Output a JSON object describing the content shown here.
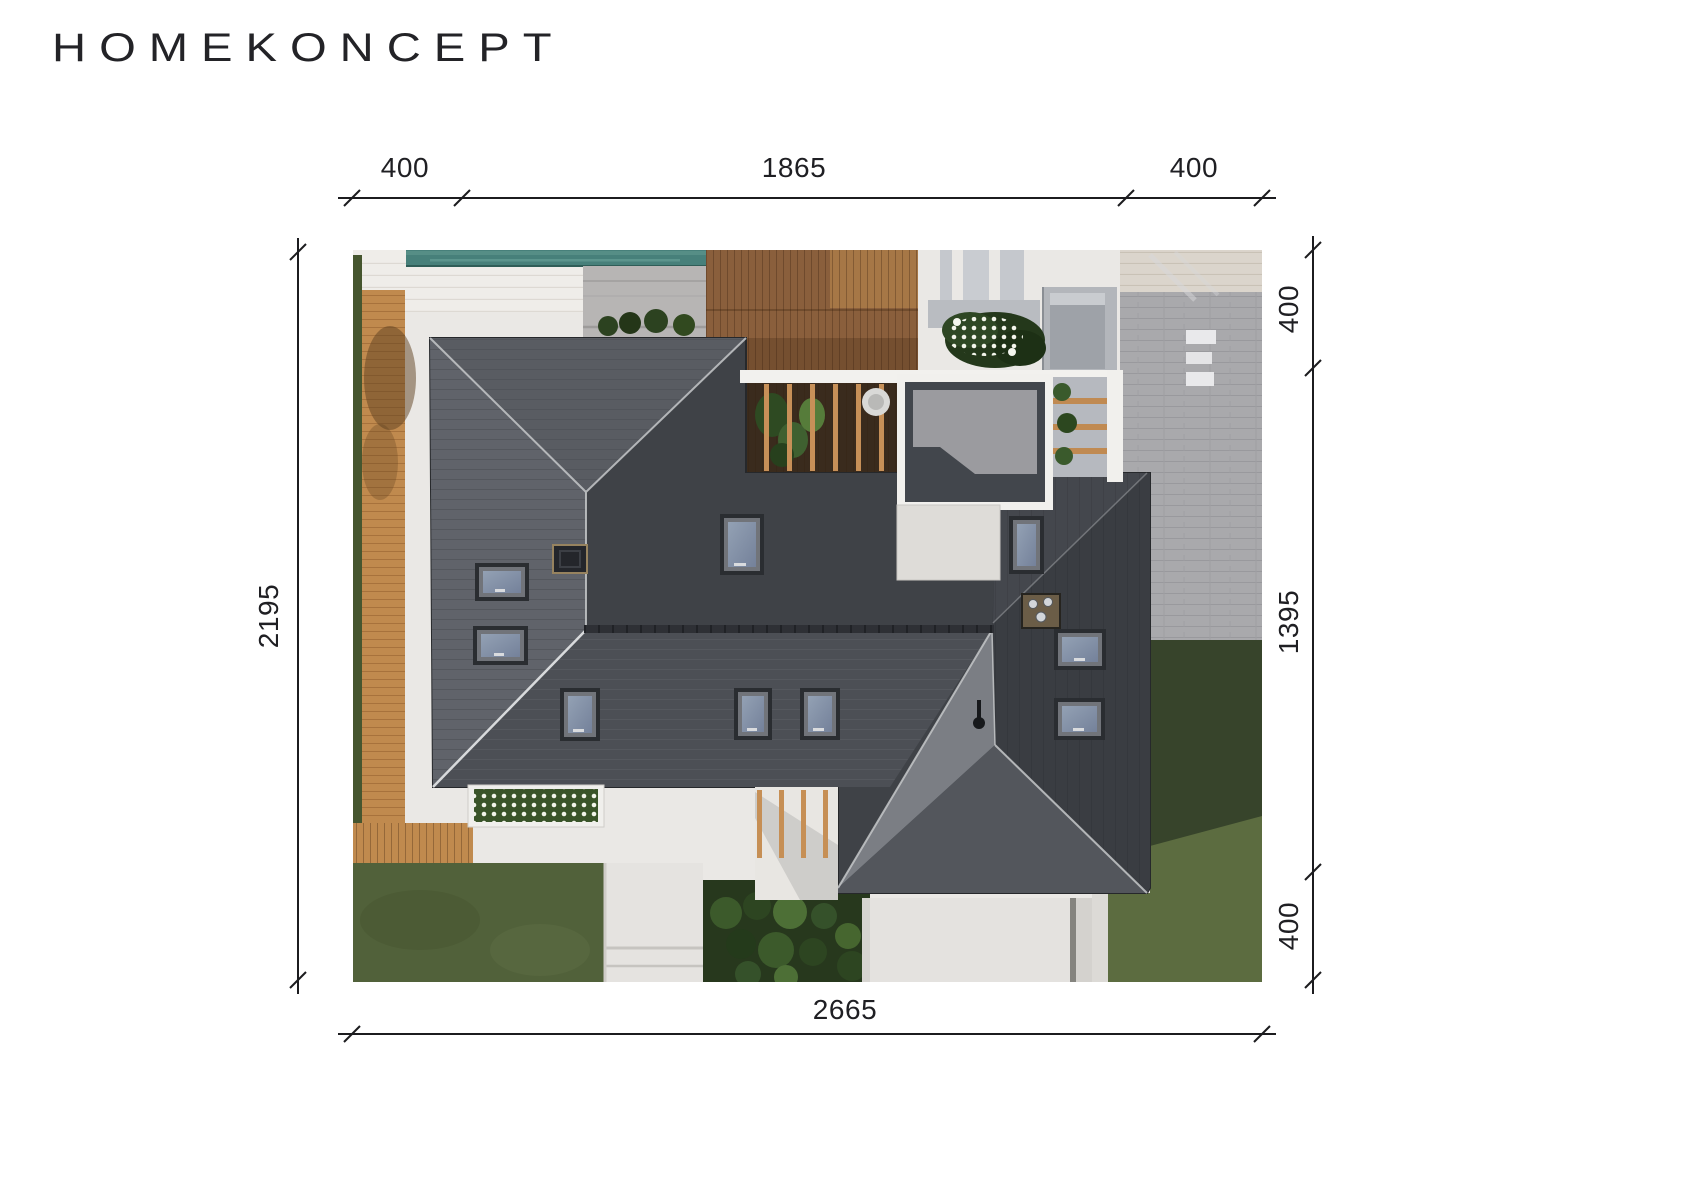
{
  "brand": {
    "logo_text": "HOMEKONCEPT"
  },
  "dimensions": {
    "top_left": "400",
    "top_middle": "1865",
    "top_right": "400",
    "right_top": "400",
    "right_middle": "1395",
    "right_bottom": "400",
    "left_side": "2195",
    "bottom": "2665"
  },
  "plan": {
    "type": "roof-site-plan-top-view",
    "elements": [
      "house-roof",
      "pool",
      "wooden-deck",
      "pergola-terrace",
      "flat-roof-box",
      "garage-wing-roof",
      "skylights",
      "chimneys",
      "paver-driveway",
      "lawn",
      "wooden-walkway",
      "entrance-path",
      "flower-beds",
      "topiary-garden"
    ],
    "colors": {
      "dimension_ink": "#1c1c1f",
      "roof_dark": "#3f4247",
      "roof_light_facet": "#7b7e84",
      "pool_water": "#47807a",
      "deck_wood": "#8a5f3c",
      "walkway_wood": "#c08a4e",
      "grass": "#55643c",
      "pavers": "#a9a9ac",
      "paving_white": "#eae8e5"
    }
  }
}
